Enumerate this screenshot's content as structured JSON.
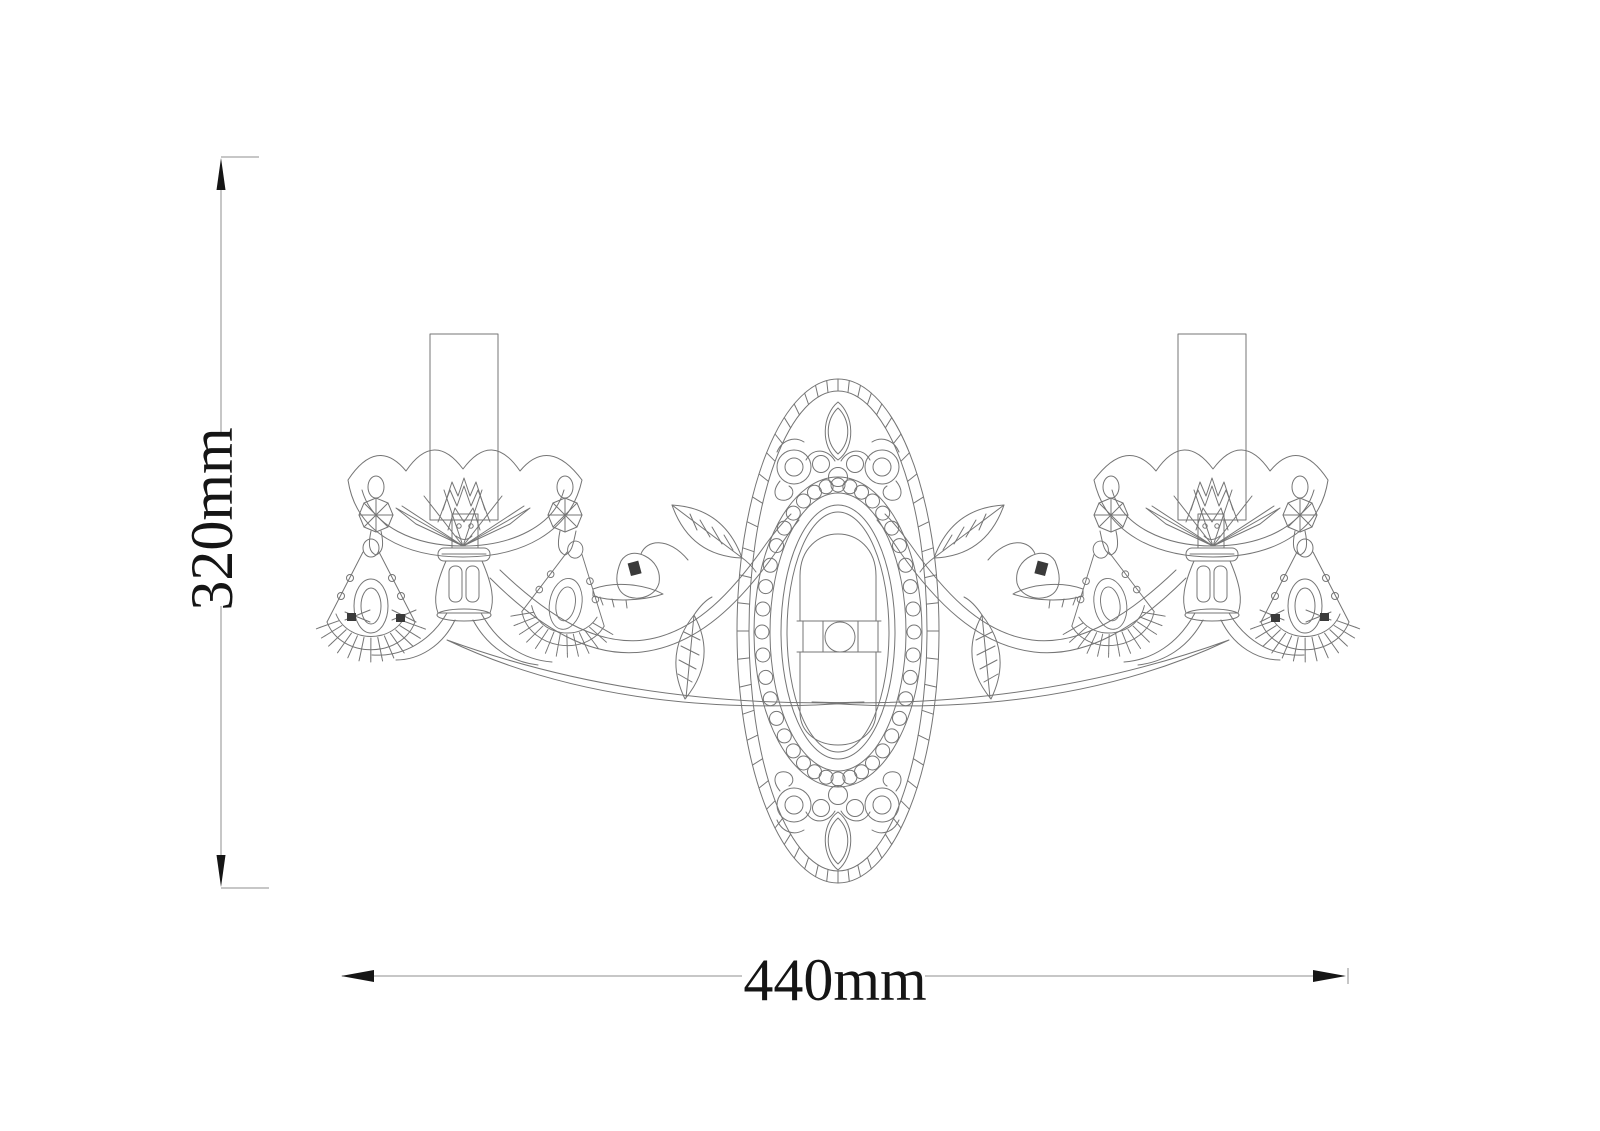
{
  "page": {
    "background": "#ffffff"
  },
  "drawing": {
    "subject": "two-arm crystal wall sconce line drawing",
    "line_color": "#757575",
    "dim_line_color": "#8f8f8f",
    "ink_color": "#151515",
    "accent_fill": "#3a3a3a"
  },
  "dimensions": {
    "height": {
      "label": "320mm",
      "orientation": "vertical"
    },
    "width": {
      "label": "440mm",
      "orientation": "horizontal"
    }
  }
}
